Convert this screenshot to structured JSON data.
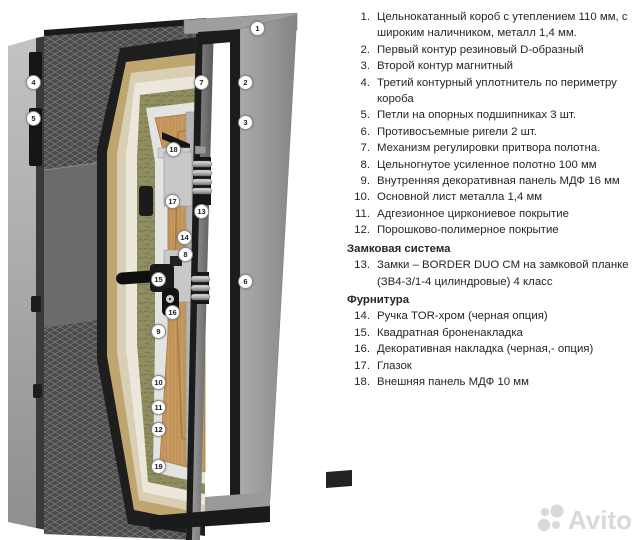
{
  "diagram": {
    "description": "3D cutaway illustration of an insulated steel entrance door with frame, hinges, seals, layered leaf and lock hardware",
    "callouts": [
      {
        "n": "1",
        "x": 257,
        "y": 28
      },
      {
        "n": "2",
        "x": 245,
        "y": 82
      },
      {
        "n": "3",
        "x": 245,
        "y": 122
      },
      {
        "n": "4",
        "x": 33,
        "y": 82
      },
      {
        "n": "5",
        "x": 33,
        "y": 118
      },
      {
        "n": "6",
        "x": 245,
        "y": 281
      },
      {
        "n": "7",
        "x": 201,
        "y": 82
      },
      {
        "n": "8",
        "x": 185,
        "y": 254
      },
      {
        "n": "9",
        "x": 158,
        "y": 331
      },
      {
        "n": "10",
        "x": 158,
        "y": 382
      },
      {
        "n": "11",
        "x": 158,
        "y": 407
      },
      {
        "n": "12",
        "x": 158,
        "y": 429
      },
      {
        "n": "13",
        "x": 201,
        "y": 211
      },
      {
        "n": "14",
        "x": 184,
        "y": 237
      },
      {
        "n": "15",
        "x": 158,
        "y": 279
      },
      {
        "n": "16",
        "x": 172,
        "y": 312
      },
      {
        "n": "17",
        "x": 172,
        "y": 201
      },
      {
        "n": "18",
        "x": 173,
        "y": 149
      },
      {
        "n": "19",
        "x": 158,
        "y": 466
      }
    ],
    "palette": {
      "background": "#ffffff",
      "door_face": "#4b4b4b",
      "face_lattice": "#808080",
      "layer_black_coating": "#1e1e1e",
      "layer_mdf_tan": "#bfa671",
      "layer_pale": "#d9cfb4",
      "layer_cream": "#ebe7da",
      "layer_mineral_wool": "#8f8e60",
      "layer_metal_white": "#e3e3e1",
      "layer_wood_panel": "#c79a60",
      "frame_gray": "#9e9e9e",
      "hardware_black": "#141414",
      "hardware_metal": "#c8c8c8",
      "callout_border": "#8e8e8e",
      "text": "#262626",
      "watermark": "#d9d9d9"
    }
  },
  "spec": {
    "rows": [
      {
        "kind": "item",
        "num": "1.",
        "text": "Цельнокатанный короб с утеплением 110 мм, с широким наличником, металл 1,4 мм."
      },
      {
        "kind": "item",
        "num": "2.",
        "text": "Первый контур резиновый D-образный"
      },
      {
        "kind": "item",
        "num": "3.",
        "text": "Второй контур магнитный"
      },
      {
        "kind": "item",
        "num": "4.",
        "text": "Третий контурный уплотнитель по периметру короба"
      },
      {
        "kind": "item",
        "num": "5.",
        "text": "Петли на опорных подшипниках 3 шт."
      },
      {
        "kind": "item",
        "num": "6.",
        "text": "Противосъемные ригели 2 шт."
      },
      {
        "kind": "item",
        "num": "7.",
        "text": "Механизм регулировки притвора полотна."
      },
      {
        "kind": "item",
        "num": "8.",
        "text": "Цельногнутое усиленное полотно 100 мм"
      },
      {
        "kind": "item",
        "num": "9.",
        "text": "Внутренняя декоративная панель МДФ 16 мм"
      },
      {
        "kind": "item",
        "num": "10.",
        "text": "Основной лист металла 1,4 мм"
      },
      {
        "kind": "item",
        "num": "11.",
        "text": "Адгезионное циркониевое покрытие"
      },
      {
        "kind": "item",
        "num": "12.",
        "text": "Порошково-полимерное покрытие"
      },
      {
        "kind": "header",
        "text": "Замковая система"
      },
      {
        "kind": "item",
        "num": "13.",
        "text": "Замки – BORDER DUO CM на замковой планке (ЗВ4-3/1-4 цилиндровые) 4 класс"
      },
      {
        "kind": "header",
        "text": "Фурнитура"
      },
      {
        "kind": "item",
        "num": "14.",
        "text": "Ручка TOR-хром (черная опция)"
      },
      {
        "kind": "item",
        "num": "15.",
        "text": "Квадратная броненакладка"
      },
      {
        "kind": "item",
        "num": "16.",
        "text": "Декоративная накладка (черная,- опция)"
      },
      {
        "kind": "item",
        "num": "17.",
        "text": "Глазок"
      },
      {
        "kind": "item",
        "num": "18.",
        "text": "Внешняя панель МДФ 10 мм"
      }
    ]
  },
  "watermark": {
    "text": "Avito"
  }
}
